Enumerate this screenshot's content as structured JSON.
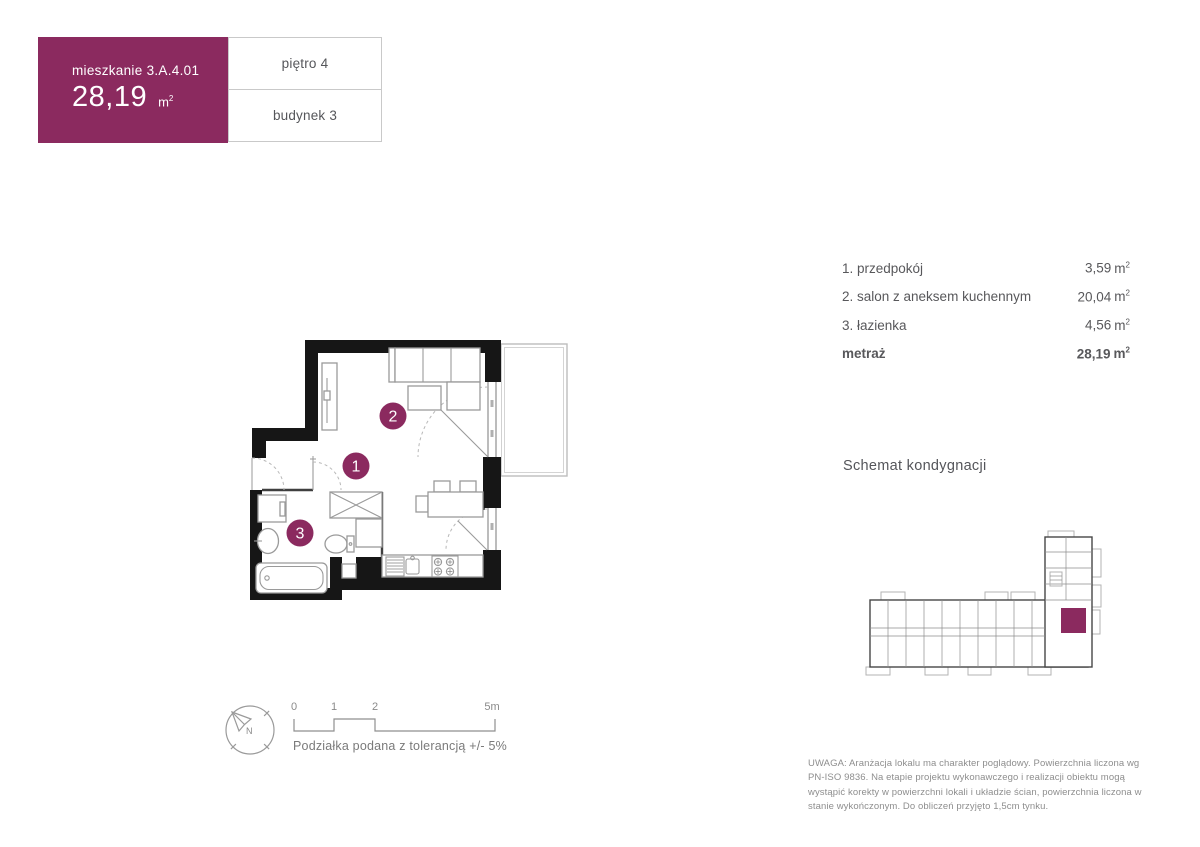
{
  "colors": {
    "accent": "#8b2a5f",
    "wall": "#161616",
    "text": "#58585b",
    "muted": "#8e8e8e",
    "border": "#c9c9c9"
  },
  "units": {
    "base": "m",
    "sup": "2"
  },
  "header": {
    "unit_name": "mieszkanie 3.A.4.01",
    "area_value": "28,19",
    "floor_label": "piętro 4",
    "building_label": "budynek 3"
  },
  "rooms": {
    "items": [
      {
        "label": "1. przedpokój",
        "area": "3,59"
      },
      {
        "label": "2. salon z aneksem kuchennym",
        "area": "20,04"
      },
      {
        "label": "3. łazienka",
        "area": "4,56"
      }
    ],
    "total_label": "metraż",
    "total_area": "28,19"
  },
  "plan": {
    "badges": [
      "1",
      "2",
      "3"
    ]
  },
  "schematic": {
    "title": "Schemat kondygnacji"
  },
  "scale": {
    "labels": [
      "0",
      "1",
      "2",
      "5m"
    ],
    "note": "Podziałka podana z tolerancją +/- 5%"
  },
  "compass": {
    "label": "N"
  },
  "disclaimer": "UWAGA: Aranżacja lokalu ma charakter poglądowy. Powierzchnia liczona wg PN-ISO 9836. Na etapie projektu wykonawczego i realizacji obiektu mogą wystąpić korekty w powierzchni lokali i układzie ścian, powierzchnia liczona w stanie wykończonym. Do obliczeń przyjęto 1,5cm tynku."
}
